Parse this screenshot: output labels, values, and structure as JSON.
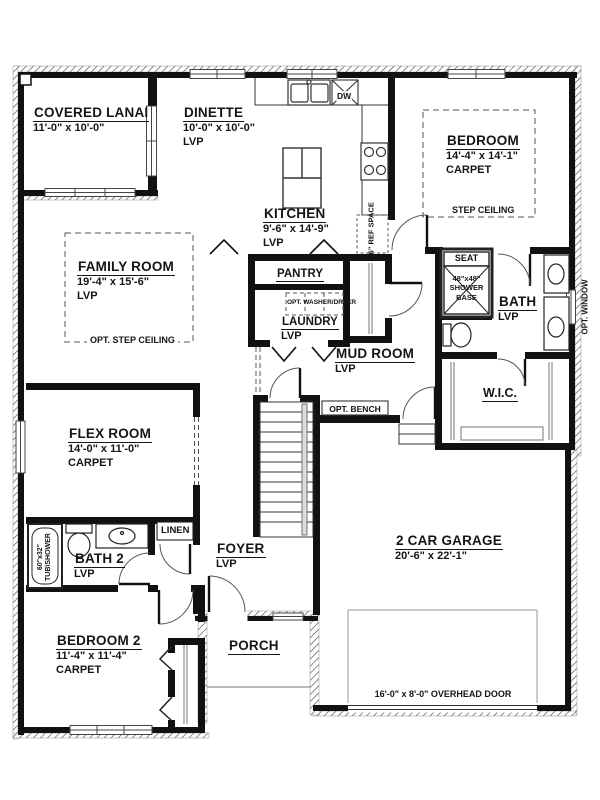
{
  "rooms": {
    "covered_lanai": {
      "name": "COVERED LANAI",
      "dims": "11'-0\" x 10'-0\""
    },
    "dinette": {
      "name": "DINETTE",
      "dims": "10'-0\" x 10'-0\"",
      "floor": "LVP"
    },
    "kitchen": {
      "name": "KITCHEN",
      "dims": "9'-6\" x 14'-9\"",
      "floor": "LVP"
    },
    "bedroom": {
      "name": "BEDROOM",
      "dims": "14'-4\" x 14'-1\"",
      "floor": "CARPET",
      "note": "STEP CEILING"
    },
    "family_room": {
      "name": "FAMILY ROOM",
      "dims": "19'-4\" x 15'-6\"",
      "floor": "LVP",
      "note": "OPT. STEP CEILING"
    },
    "pantry": {
      "name": "PANTRY"
    },
    "laundry": {
      "name": "LAUNDRY",
      "floor": "LVP",
      "note": "OPT. WASHER/DRYER"
    },
    "mud_room": {
      "name": "MUD ROOM",
      "floor": "LVP"
    },
    "bath": {
      "name": "BATH",
      "floor": "LVP"
    },
    "wic": {
      "name": "W.I.C."
    },
    "flex_room": {
      "name": "FLEX ROOM",
      "dims": "14'-0\" x 11'-0\"",
      "floor": "CARPET"
    },
    "bath2": {
      "name": "BATH 2",
      "floor": "LVP"
    },
    "linen": {
      "name": "LINEN"
    },
    "foyer": {
      "name": "FOYER",
      "floor": "LVP"
    },
    "bedroom2": {
      "name": "BEDROOM 2",
      "dims": "11'-4\" x 11'-4\"",
      "floor": "CARPET"
    },
    "porch": {
      "name": "PORCH"
    },
    "garage": {
      "name": "2 CAR GARAGE",
      "dims": "20'-6\" x 22'-1\""
    }
  },
  "annotations": {
    "seat": "SEAT",
    "shower_size": "48\"x48\"",
    "shower_l1": "SHOWER",
    "shower_l2": "BASE",
    "opt_bench": "OPT. BENCH",
    "dishwasher": "DW",
    "ref_space": "36\" REF SPACE",
    "opt_window": "OPT. WINDOW",
    "tub_size": "60\"x32\"",
    "tub_label": "TUB\\SHOWER",
    "overhead_door": "16'-0\" x 8'-0\" OVERHEAD DOOR",
    "opt_washer_dryer": "OPT. WASHER/DRYER"
  },
  "colors": {
    "wall": "#111111",
    "text": "#151515",
    "background": "#ffffff"
  }
}
